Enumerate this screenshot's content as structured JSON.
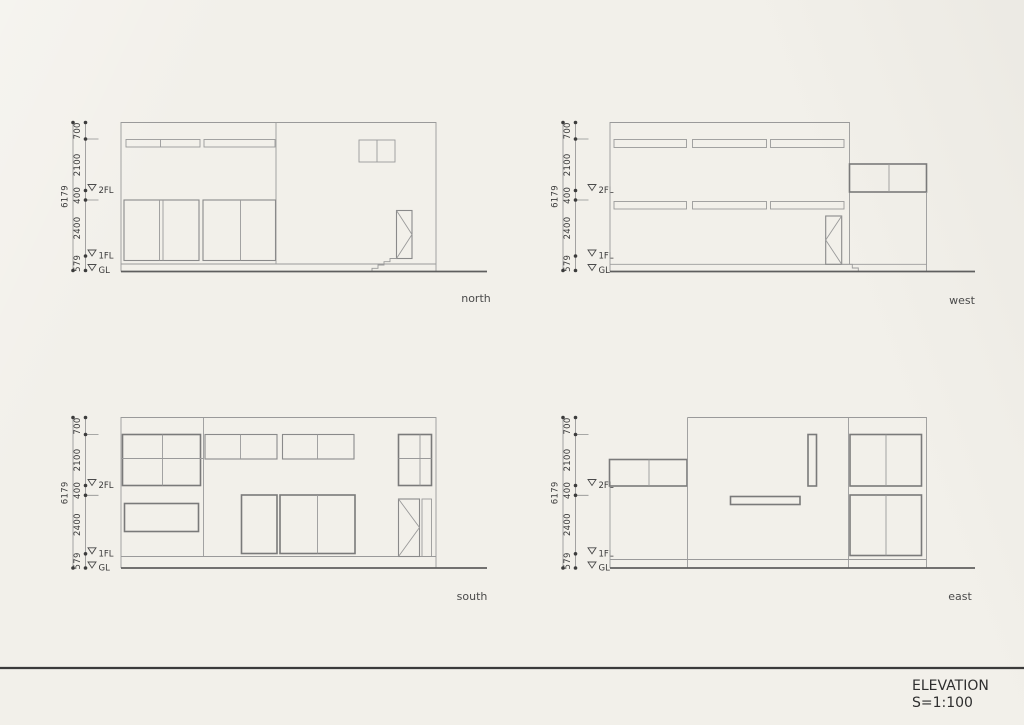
{
  "sheet": {
    "title": "ELEVATION",
    "scale": "S=1:100",
    "label_north": "north",
    "label_west": "west",
    "label_south": "south",
    "label_east": "east"
  },
  "dims": {
    "total": "6179",
    "segments": [
      "700",
      "2100",
      "400",
      "2400",
      "579"
    ],
    "level_2fl": "2FL",
    "level_1fl": "1FL",
    "level_gl": "GL"
  },
  "colors": {
    "paper": "#f2f0ea",
    "thin_line": "#9a9a9a",
    "frame_line": "#7a7a7a",
    "ground_line": "#5f5f5f",
    "text": "#3a3a3a"
  }
}
